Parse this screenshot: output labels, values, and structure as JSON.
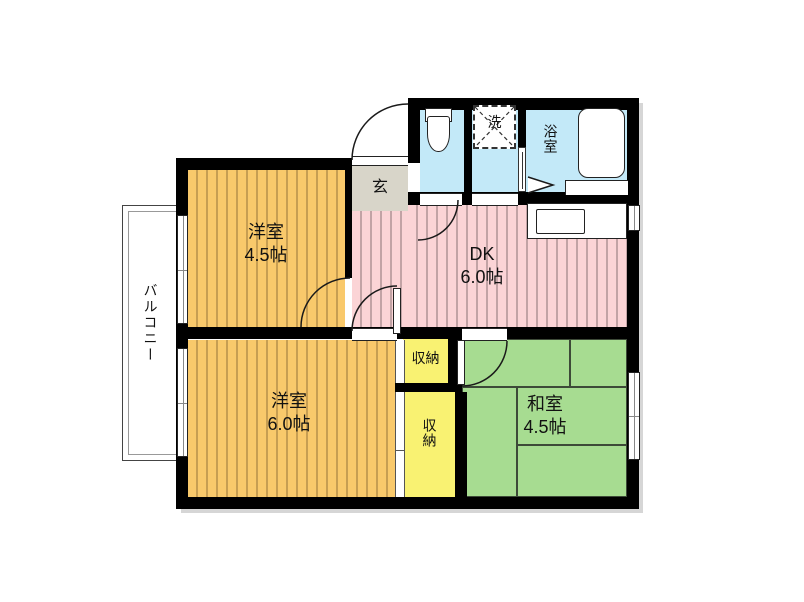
{
  "rooms": {
    "western_room_small": {
      "name": "洋室",
      "size": "4.5帖"
    },
    "dk": {
      "name": "DK",
      "size": "6.0帖"
    },
    "western_room_large": {
      "name": "洋室",
      "size": "6.0帖"
    },
    "japanese_room": {
      "name": "和室",
      "size": "4.5帖"
    },
    "entrance": {
      "name": "玄"
    },
    "balcony": {
      "name": "バルコニー"
    },
    "bathroom": {
      "name": "浴室"
    },
    "laundry": {
      "name": "洗"
    },
    "storage_upper": {
      "name": "収納"
    },
    "storage_lower": {
      "name": "収納"
    }
  },
  "colors": {
    "wall": "#000000",
    "orange": "#F9C96B",
    "orangeStripe": "#C79E52",
    "pink": "#FBD4D6",
    "pinkStripe": "#C2A3A5",
    "green": "#A7DC91",
    "tatamiLine": "#3d4a38",
    "yellow": "#F9F272",
    "blue": "#C3E9F8",
    "beige": "#D8D5C9"
  }
}
